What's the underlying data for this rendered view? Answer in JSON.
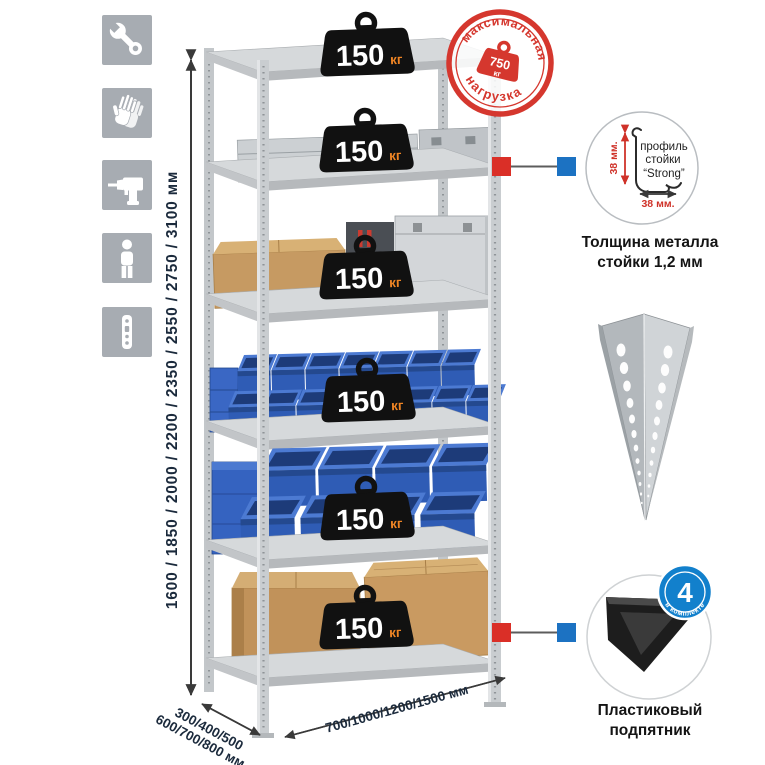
{
  "dimensions": {
    "height_options": "1600 / 1850 / 2000 / 2200 / 2350 / 2550 / 2750 / 3100 мм",
    "depth_options_line1": "300/400/500",
    "depth_options_line2": "600/700/800 мм",
    "width_options": "700/1000/1200/1500 мм"
  },
  "rack": {
    "weights": [
      {
        "value": "150",
        "unit": "кг"
      },
      {
        "value": "150",
        "unit": "кг"
      },
      {
        "value": "150",
        "unit": "кг"
      },
      {
        "value": "150",
        "unit": "кг"
      },
      {
        "value": "150",
        "unit": "кг"
      },
      {
        "value": "150",
        "unit": "кг"
      }
    ]
  },
  "stamp": {
    "arc_top": "максимальная",
    "arc_bottom": "нагрузка",
    "value": "750",
    "unit": "кг"
  },
  "profile_detail": {
    "line1": "профиль",
    "line2": "стойки",
    "line3": "“Strong”",
    "dim_vertical": "38 мм.",
    "dim_horizontal": "38 мм.",
    "caption_line1": "Толщина металла",
    "caption_line2": "стойки 1,2 мм"
  },
  "foot_detail": {
    "badge_value": "4",
    "badge_text": "в комплекте",
    "caption_line1": "Пластиковый",
    "caption_line2": "подпятник"
  },
  "sidebar": {
    "icons": [
      "wrench",
      "gloves",
      "drill",
      "person",
      "perforated-post"
    ]
  },
  "colors": {
    "accent_red": "#d5372e",
    "accent_blue": "#1c77c4",
    "weight_black": "#111111",
    "unit_orange": "#ee8424",
    "dim_text_navy": "#1b2a3c",
    "metal_gray": "#cdd0d3",
    "bin_blue": "#2f5cb5",
    "icon_gray": "#a7acb2"
  }
}
